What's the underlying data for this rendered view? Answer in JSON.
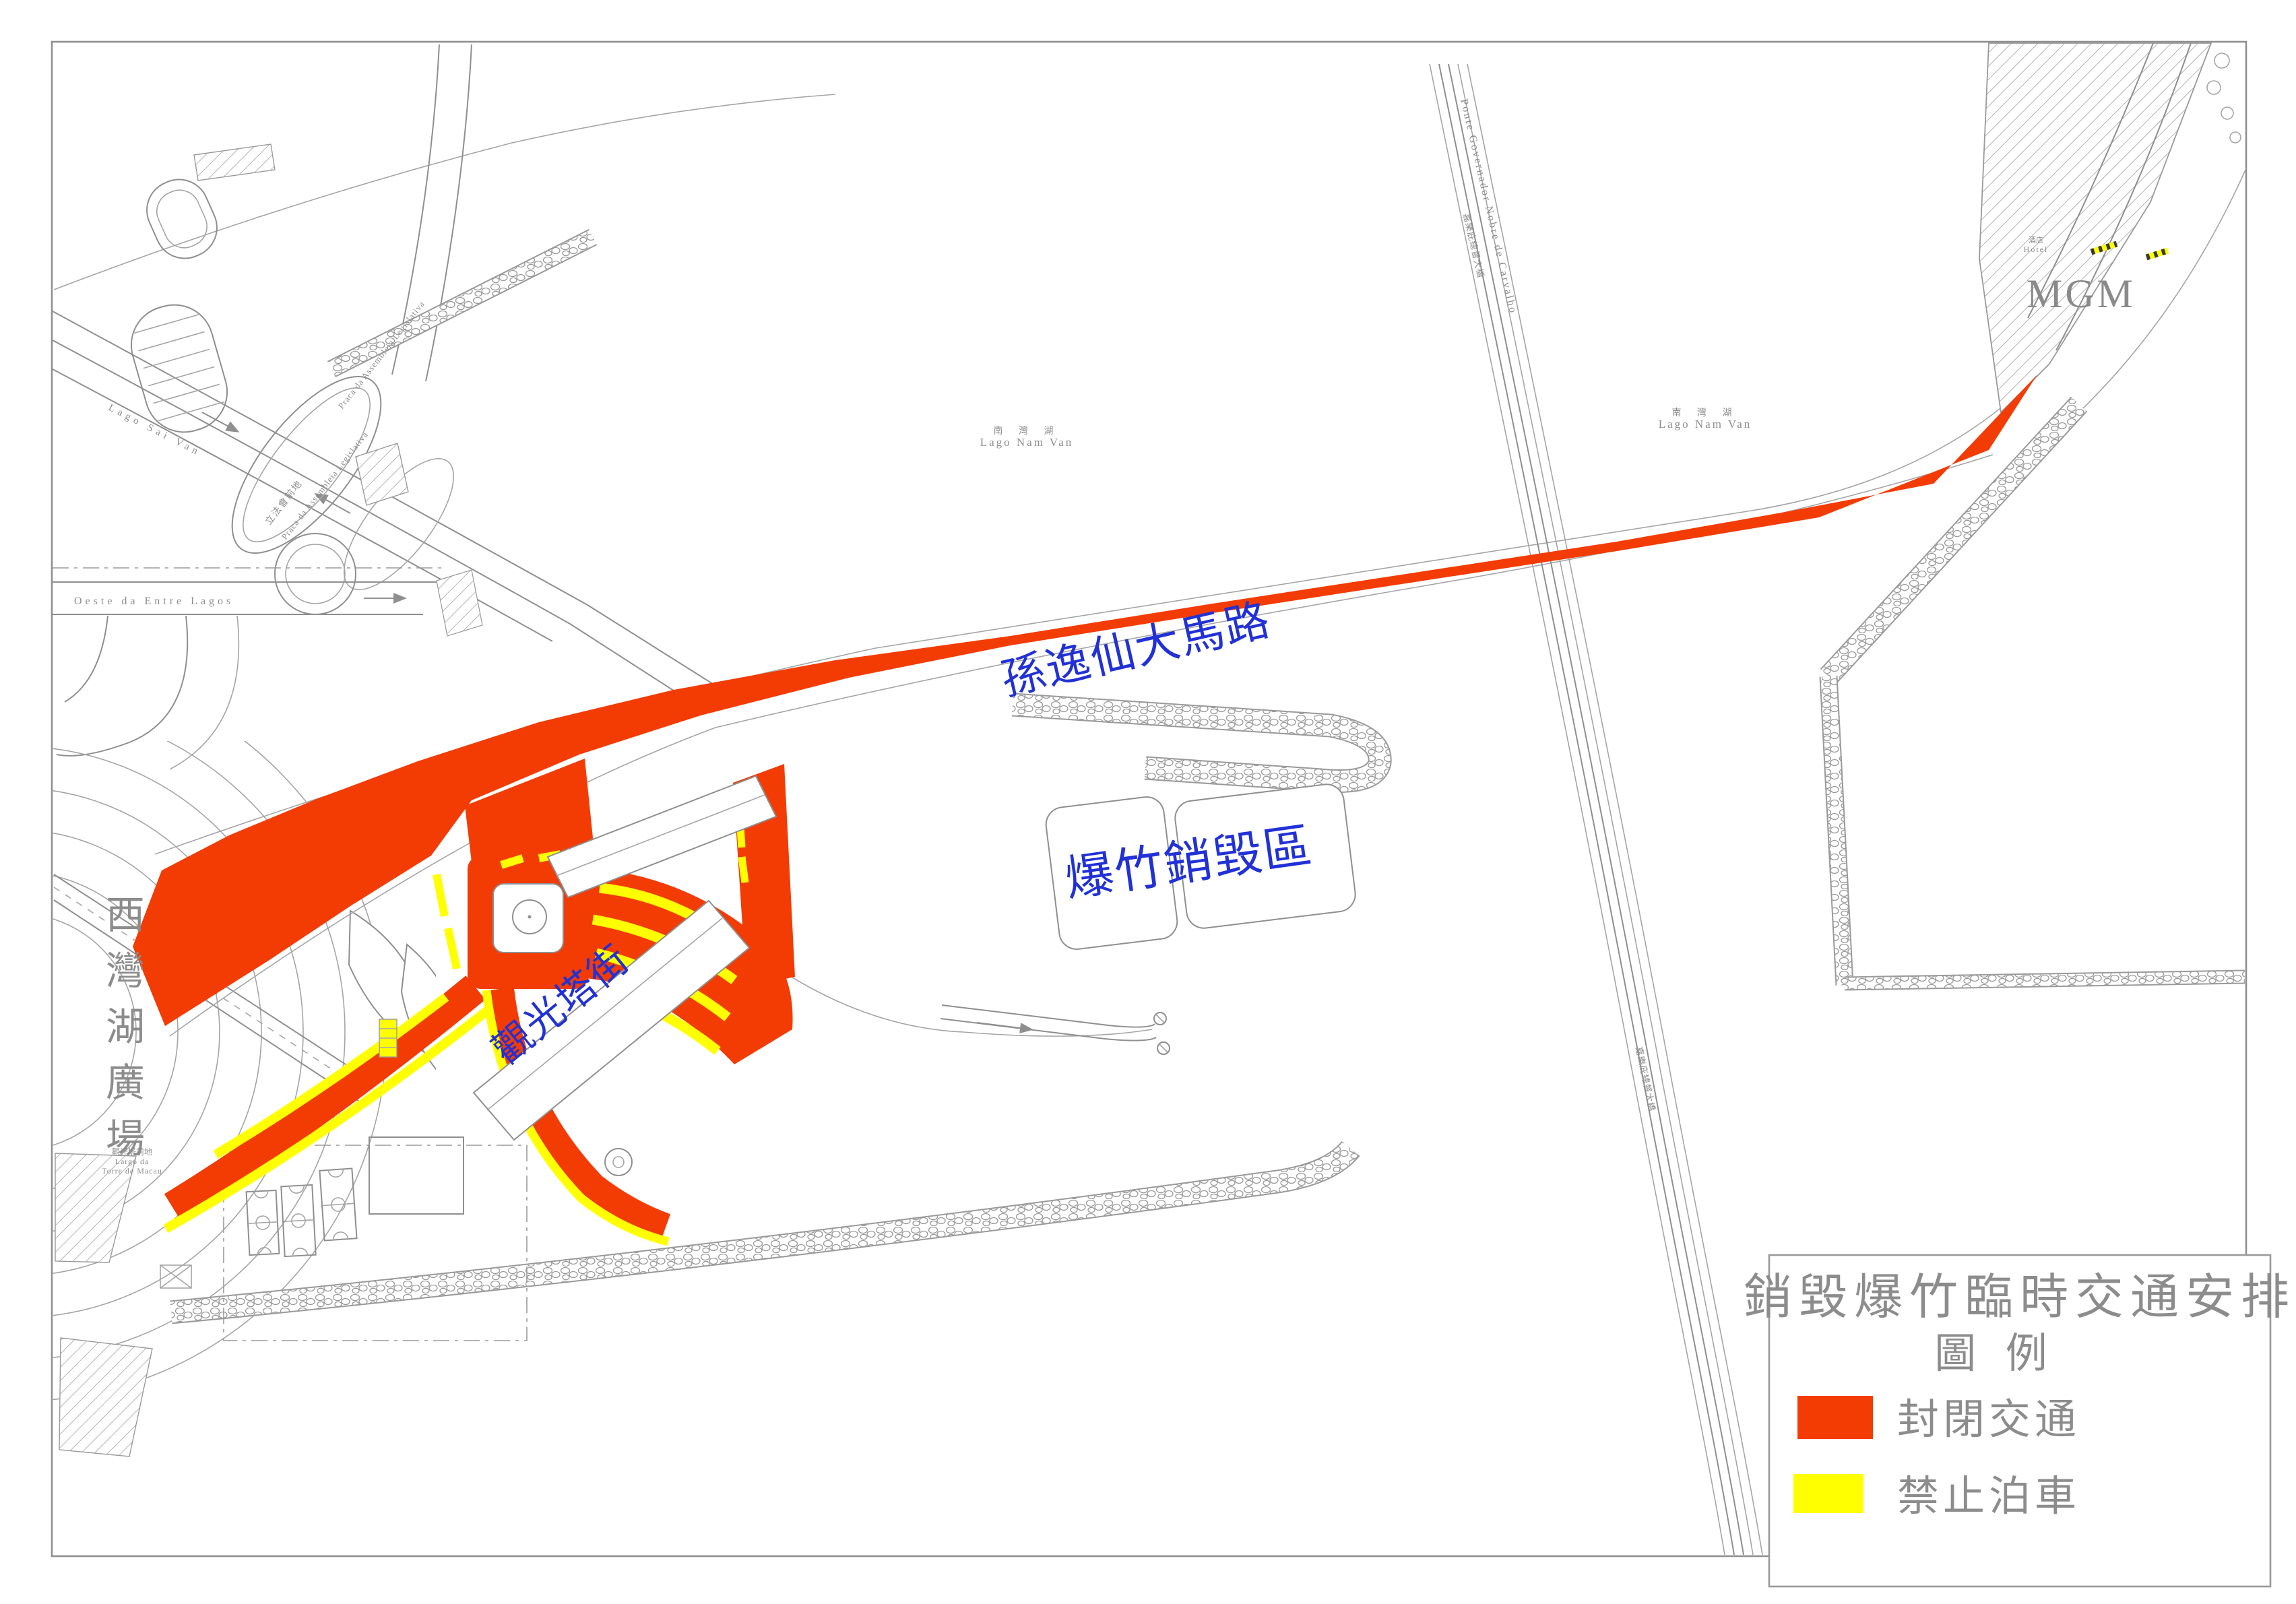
{
  "document": {
    "type": "traffic-arrangement-drawing",
    "background": "#ffffff",
    "frame_color": "#8f8f8f"
  },
  "colors": {
    "closed_traffic": "#f23c04",
    "no_parking": "#ffff00",
    "cad_line": "#8f8f8f",
    "label_blue": "#2131d6",
    "label_gray": "#8c8c8c"
  },
  "legend": {
    "title": "銷毀爆竹臨時交通安排",
    "subtitle": "圖  例",
    "items": [
      {
        "label": "封閉交通",
        "color": "#f23c04",
        "meaning": "closed-to-traffic"
      },
      {
        "label": "禁止泊車",
        "color": "#ffff00",
        "meaning": "no-parking"
      }
    ]
  },
  "map_labels": {
    "avenue": "孫逸仙大馬路",
    "destruction_zone": "爆竹銷毀區",
    "tower_street": "觀光塔街",
    "plaza_vertical": [
      "西",
      "灣",
      "湖",
      "廣",
      "場"
    ],
    "lake_cn": "南  灣  湖",
    "lake_pt": "Lago Nam Van",
    "bridge_pt": "Ponte Governador Nobre de Carvalho",
    "bridge_cn": "嘉樂庇總督大橋",
    "mgm": "MGM",
    "hotel_cn": "酒店",
    "hotel_en": "Hotel",
    "tower_plaza_cn": "觀光塔前地",
    "tower_plaza_pt_1": "Largo da",
    "tower_plaza_pt_2": "Torre de Macau",
    "assembly_cn": "立法會前地",
    "assembly_pt": "Praca da Assembleia Legislativa",
    "lago_sai_van": "Lago  Sai  Van",
    "street_entre_lagos": "Oeste   da   Entre   Lagos"
  }
}
